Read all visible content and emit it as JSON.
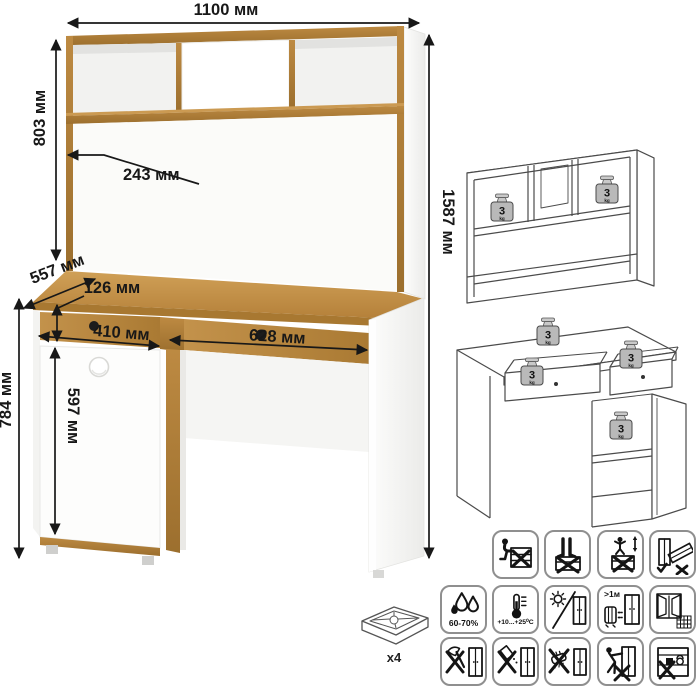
{
  "card": {
    "dimensions": {
      "top_width": "1100 мм",
      "hutch_height": "803 мм",
      "niche_depth": "243 мм",
      "total_height": "1587 мм",
      "depth": "557 мм",
      "drawer_front_height": "126 мм",
      "left_drawer_width": "410 мм",
      "right_drawer_width": "628 мм",
      "table_height": "784 мм",
      "door_height": "597 мм"
    },
    "load_badge": {
      "value": "3",
      "unit": "kg"
    },
    "feet_count": "x4",
    "care_icons": {
      "row1": [
        {
          "name": "no-sitting"
        },
        {
          "name": "no-standing"
        },
        {
          "name": "no-jumping"
        },
        {
          "name": "transport-upright"
        }
      ],
      "row2": [
        {
          "name": "humidity-range",
          "label": "60-70%"
        },
        {
          "name": "temperature-range",
          "label": "+10...+25⁰C"
        },
        {
          "name": "avoid-direct-sunlight"
        },
        {
          "name": "heater-distance",
          "label": ">1м"
        },
        {
          "name": "ventilation-window"
        }
      ],
      "row3": [
        {
          "name": "no-sharp-tools"
        },
        {
          "name": "no-spilling-liquids"
        },
        {
          "name": "no-abrasive-cleaning"
        },
        {
          "name": "no-dragging"
        },
        {
          "name": "no-heavy-items-inside"
        }
      ]
    }
  }
}
